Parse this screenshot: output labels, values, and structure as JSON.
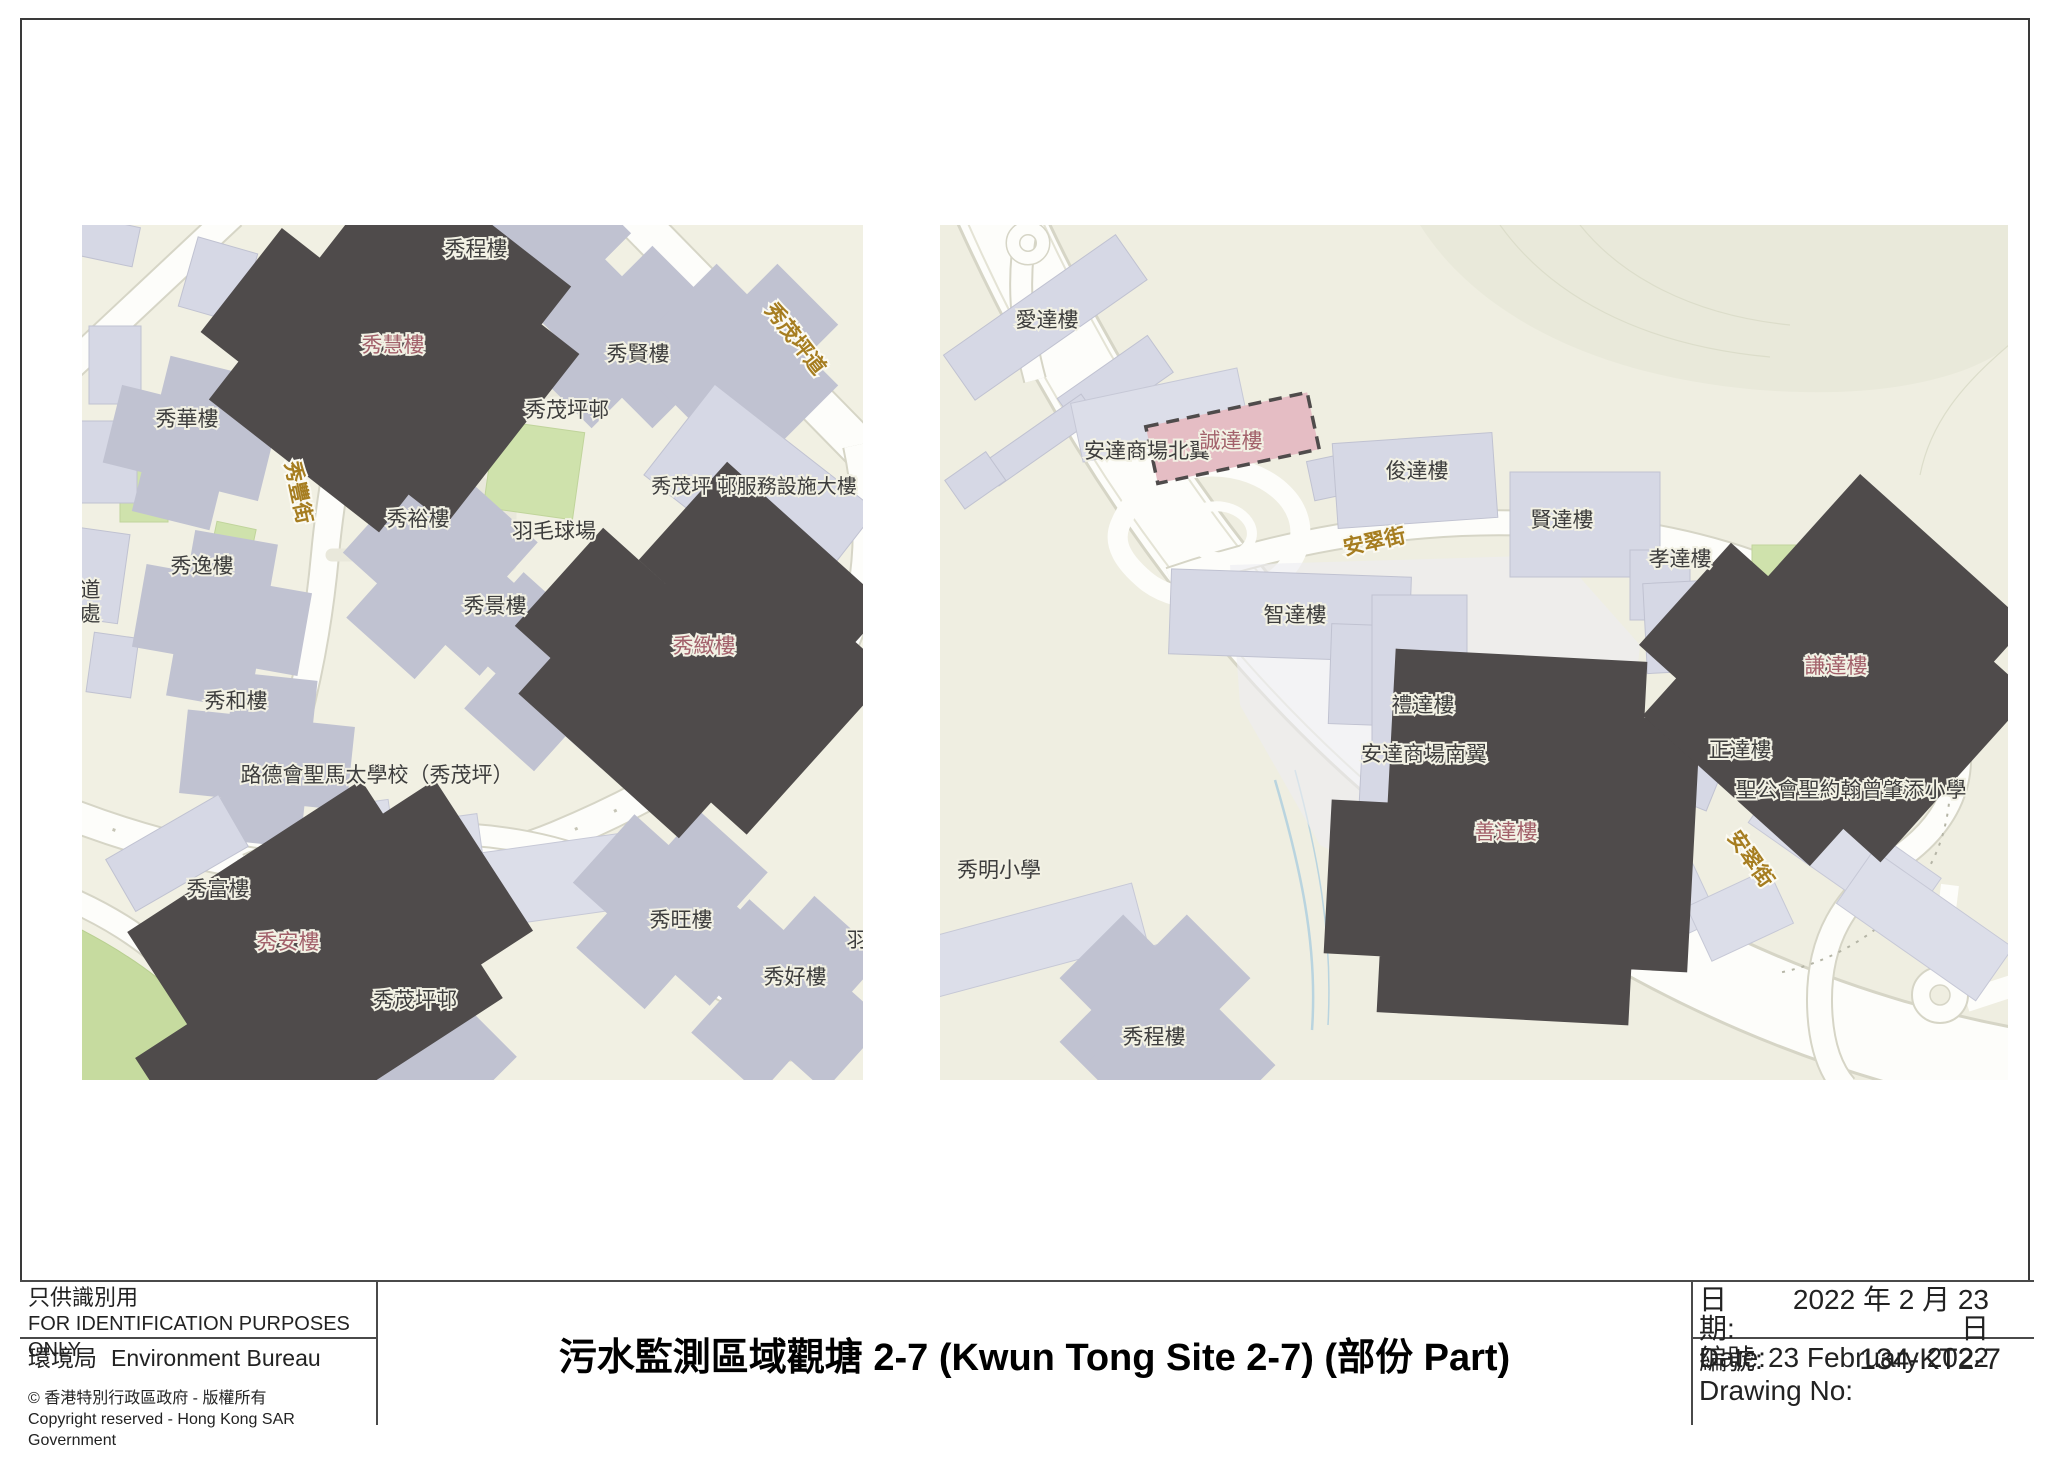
{
  "footer": {
    "identification_zh": "只供識別用",
    "identification_en": "FOR IDENTIFICATION PURPOSES ONLY",
    "bureau_zh": "環境局",
    "bureau_en": "Environment Bureau",
    "copyright_zh": "© 香港特別行政區政府 - 版權所有",
    "copyright_en": "Copyright reserved - Hong Kong SAR Government",
    "title": "污水監測區域觀塘 2-7 (Kwun Tong Site 2-7) (部份 Part)",
    "date_label_zh": "日期:",
    "date_value_zh": "2022 年 2 月 23 日",
    "date_label_en": "Date:",
    "date_value_en": "23 February 2022",
    "drawing_no_label_zh": "編號:",
    "drawing_no_value": "134-KT2-7",
    "drawing_no_label_en": "Drawing No:"
  },
  "maps": {
    "left": {
      "streets": [
        {
          "text": "秀豐街"
        },
        {
          "text": "秀茂坪道"
        }
      ],
      "labels": [
        {
          "text": "秀程樓"
        },
        {
          "text": "秀慧樓"
        },
        {
          "text": "秀賢樓"
        },
        {
          "text": "秀茂坪邨"
        },
        {
          "text": "秀華樓"
        },
        {
          "text": "秀茂坪 邨服務設施大樓"
        },
        {
          "text": "秀裕樓"
        },
        {
          "text": "羽毛球場"
        },
        {
          "text": "秀逸樓"
        },
        {
          "text": "道"
        },
        {
          "text": "處"
        },
        {
          "text": "秀景樓"
        },
        {
          "text": "秀緻樓"
        },
        {
          "text": "秀和樓"
        },
        {
          "text": "路德會聖馬太學校（秀茂坪）"
        },
        {
          "text": "秀富樓"
        },
        {
          "text": "秀安樓"
        },
        {
          "text": "秀茂坪邨"
        },
        {
          "text": "秀旺樓"
        },
        {
          "text": "秀好樓"
        },
        {
          "text": "羽"
        }
      ],
      "highlighted": [
        "秀慧樓",
        "秀緻樓",
        "秀安樓"
      ]
    },
    "right": {
      "streets": [
        {
          "text": "安翠街"
        },
        {
          "text": "安翠街"
        }
      ],
      "labels": [
        {
          "text": "愛達樓"
        },
        {
          "text": "安達商場北翼"
        },
        {
          "text": "誠達樓"
        },
        {
          "text": "俊達樓"
        },
        {
          "text": "賢達樓"
        },
        {
          "text": "孝達樓"
        },
        {
          "text": "智達樓"
        },
        {
          "text": "禮達樓"
        },
        {
          "text": "安達商場南翼"
        },
        {
          "text": "善達樓"
        },
        {
          "text": "謙達樓"
        },
        {
          "text": "正達樓"
        },
        {
          "text": "聖公會聖約翰曾肇添小學"
        },
        {
          "text": "秀明小學"
        },
        {
          "text": "秀程樓"
        }
      ],
      "highlighted": [
        "誠達樓",
        "善達樓",
        "謙達樓"
      ]
    }
  },
  "colors": {
    "highlight_fill": "#e5bdc4",
    "highlight_border": "#4f4b4b",
    "street_label": "#a67d20",
    "building_fill": "#d6d8e5",
    "map_background": "#f1f0e3",
    "green_area": "#cfe2ac"
  }
}
